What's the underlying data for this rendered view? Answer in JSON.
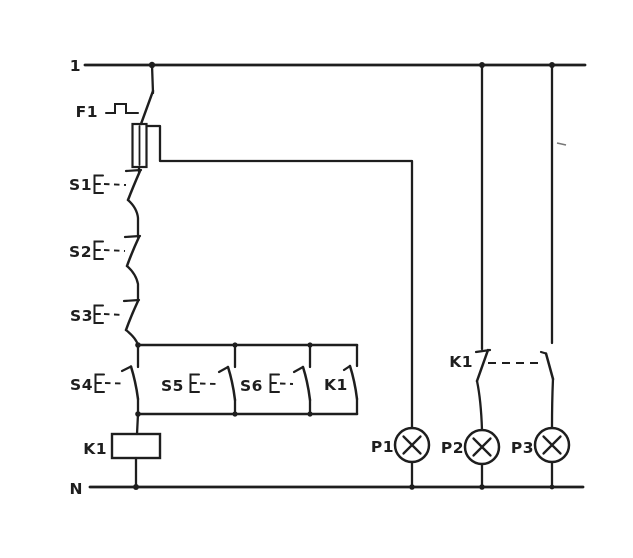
{
  "colors": {
    "ink": "#1e1e1e",
    "paper": "#ffffff"
  },
  "buses": {
    "top": {
      "label": "1"
    },
    "neutral": {
      "label": "N"
    }
  },
  "components": {
    "f1": {
      "label": "F1"
    },
    "s1": {
      "label": "S1"
    },
    "s2": {
      "label": "S2"
    },
    "s3": {
      "label": "S3"
    },
    "s4": {
      "label": "S4"
    },
    "s5": {
      "label": "S5"
    },
    "s6": {
      "label": "S6"
    },
    "k1_coil": {
      "label": "K1"
    },
    "k1_aux": {
      "label": "K1"
    },
    "k1_changeover": {
      "label": "K1"
    },
    "p1": {
      "label": "P1"
    },
    "p2": {
      "label": "P2"
    },
    "p3": {
      "label": "P3"
    }
  }
}
